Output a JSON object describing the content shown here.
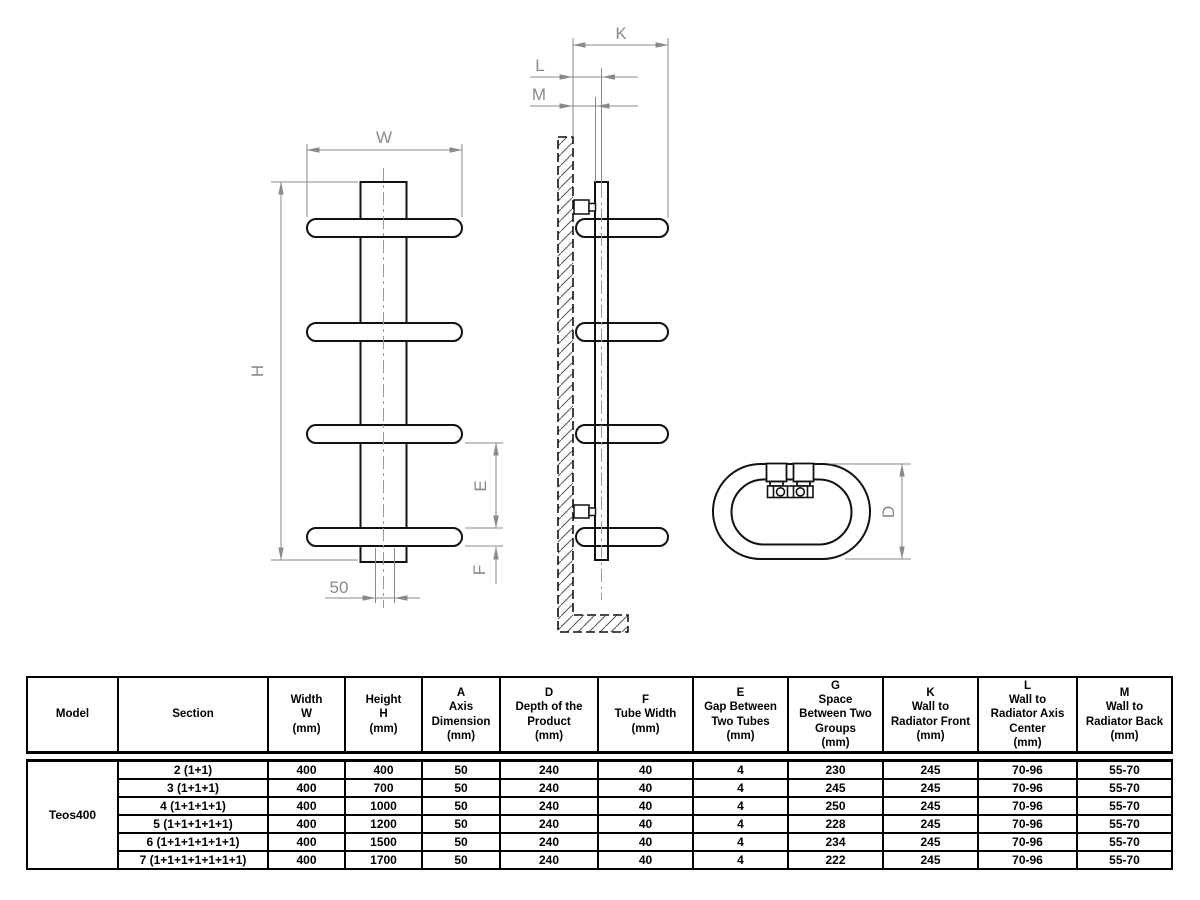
{
  "drawing": {
    "labels": {
      "w": "W",
      "h": "H",
      "e": "E",
      "f": "F",
      "axis": "50",
      "k": "K",
      "l": "L",
      "m": "M",
      "d": "D"
    }
  },
  "table": {
    "model": "Teos400",
    "headers": [
      "Model",
      "Section",
      "Width\nW\n(mm)",
      "Height\nH\n(mm)",
      "A\nAxis\nDimension\n(mm)",
      "D\nDepth of the\nProduct\n(mm)",
      "F\nTube Width\n(mm)",
      "E\nGap Between\nTwo Tubes\n(mm)",
      "G\nSpace\nBetween Two\nGroups\n(mm)",
      "K\nWall to\nRadiator Front\n(mm)",
      "L\nWall to\nRadiator  Axis\nCenter\n(mm)",
      "M\nWall to\nRadiator  Back\n(mm)"
    ],
    "rows": [
      {
        "section": "2 (1+1)",
        "values": [
          "400",
          "400",
          "50",
          "240",
          "40",
          "4",
          "230",
          "245",
          "70-96",
          "55-70"
        ]
      },
      {
        "section": "3 (1+1+1)",
        "values": [
          "400",
          "700",
          "50",
          "240",
          "40",
          "4",
          "245",
          "245",
          "70-96",
          "55-70"
        ]
      },
      {
        "section": "4 (1+1+1+1)",
        "values": [
          "400",
          "1000",
          "50",
          "240",
          "40",
          "4",
          "250",
          "245",
          "70-96",
          "55-70"
        ]
      },
      {
        "section": "5 (1+1+1+1+1)",
        "values": [
          "400",
          "1200",
          "50",
          "240",
          "40",
          "4",
          "228",
          "245",
          "70-96",
          "55-70"
        ]
      },
      {
        "section": "6 (1+1+1+1+1+1)",
        "values": [
          "400",
          "1500",
          "50",
          "240",
          "40",
          "4",
          "234",
          "245",
          "70-96",
          "55-70"
        ]
      },
      {
        "section": "7 (1+1+1+1+1+1+1)",
        "values": [
          "400",
          "1700",
          "50",
          "240",
          "40",
          "4",
          "222",
          "245",
          "70-96",
          "55-70"
        ]
      }
    ]
  }
}
